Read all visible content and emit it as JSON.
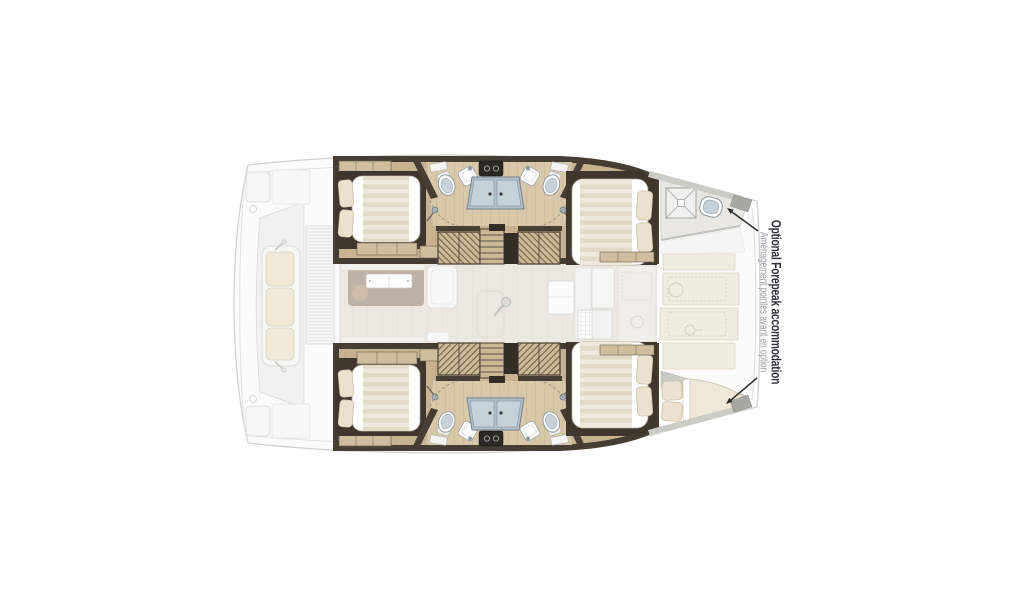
{
  "page": {
    "background": "#ffffff"
  },
  "diagram": {
    "type": "catamaran-deck-plan",
    "annotation": {
      "title": "Optional Forepeak accommodation",
      "subtitle": "Aménagement pointes avant en option"
    },
    "colors": {
      "hull_wall": "#473e33",
      "cabin_floor": "#c8b292",
      "heads_floor": "#d8c8a9",
      "mattress": "#ffffff",
      "pillow": "#eae2cf",
      "shower": "#b3c0ca",
      "toilet_lid": "#c6d1d9",
      "stairs": "#cbb997",
      "forepeak_floor": "#e8e7e2",
      "foredeck_panel": "#f0ebdf",
      "saloon_floor": "#ece8e1",
      "rug": "#beb2a6",
      "arrow": "#2e2e2c",
      "annotation_title": "#30303d",
      "annotation_subtitle": "#9b9ba1"
    },
    "features": {
      "upper_hull": {
        "rooms": [
          "aft-double-cabin",
          "heads-with-twin-toilets-sinks-and-shower",
          "companionway-stairs",
          "forward-double-cabin"
        ],
        "forepeak": "forepeak-with-deck-hatch-and-sea-toilet"
      },
      "lower_hull": {
        "rooms": [
          "aft-double-cabin",
          "heads-with-twin-toilets-sinks-and-shower",
          "companionway-stairs",
          "forward-double-cabin"
        ],
        "forepeak": "forepeak-with-single-berth"
      },
      "midship": [
        "saloon-rug-and-coffee-table",
        "chaise-seat",
        "pedestal-table",
        "galley-counters",
        "grid-hatch"
      ],
      "stern": [
        "cockpit-bench-with-cushions",
        "louvered-door",
        "transom-platforms"
      ],
      "bow": [
        "foredeck-locker-panels",
        "bow-caps"
      ]
    }
  }
}
